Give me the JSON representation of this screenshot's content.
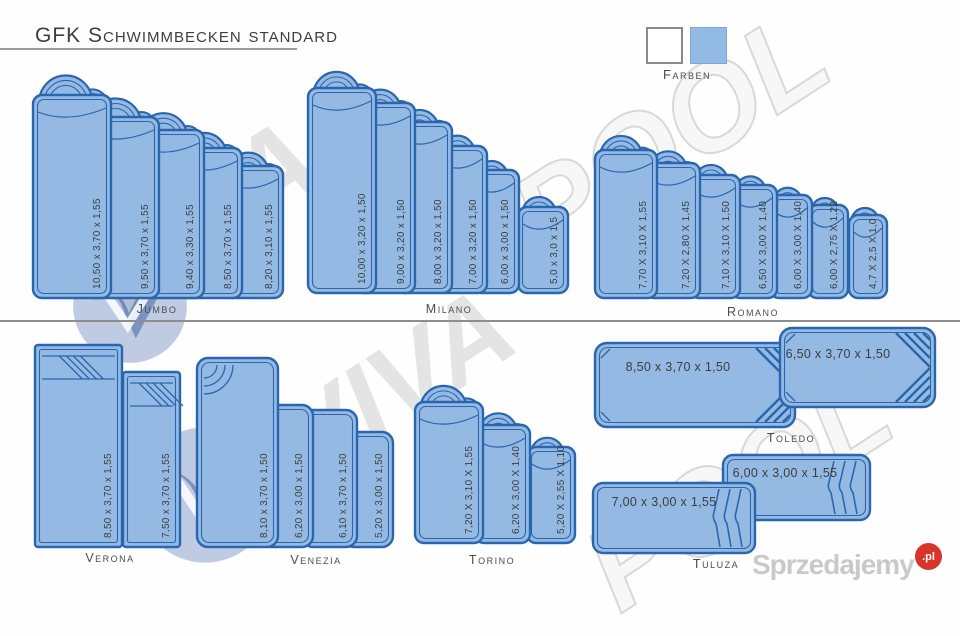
{
  "title": "GFK Schwimmbecken standard",
  "legend": {
    "label": "Farben",
    "swatches": [
      {
        "name": "white",
        "color": "#ffffff"
      },
      {
        "name": "blue",
        "color": "#93bae3"
      }
    ]
  },
  "groups": {
    "jumbo": {
      "label": "Jumbo",
      "pools": [
        "10,50 x 3,70 x 1,55",
        "9,50 x 3,70 x 1,55",
        "9,40 x 3,30 x 1,55",
        "8,50 x 3,70 x 1,55",
        "8,20 x 3,10 x 1,55"
      ]
    },
    "milano": {
      "label": "Milano",
      "pools": [
        "10,00 x 3,20 x 1,50",
        "9,00 x 3,20 x 1,50",
        "8,00 x 3,20 x 1,50",
        "7,00 x 3,20 x 1,50",
        "6,00 x 3,00 x 1,50",
        "5,0 x 3,0 x 1,5"
      ]
    },
    "romano": {
      "label": "Romano",
      "pools": [
        "7,70 X 3,10 X 1,55",
        "7,20 X 2,80 X 1,45",
        "7,10 X 3,10 X 1,50",
        "6,50 X 3,00 X 1,40",
        "6,00 X 3,00 X 1,40",
        "6,00 X 2,75 X 1,22",
        "4,7 X 2,5 X 1,0"
      ]
    },
    "verona": {
      "label": "Verona",
      "pools": [
        "8,50 x 3,70 x 1,55",
        "7,50 x 3,70 x 1,55"
      ]
    },
    "venezia": {
      "label": "Venezia",
      "pools": [
        "8,10 x 3,70 x 1,50",
        "6,20 x 3,00 x 1,50",
        "6,10 x 3,70 x 1,50",
        "5,20 x 3,00 x 1,50"
      ]
    },
    "torino": {
      "label": "Torino",
      "pools": [
        "7,20 X 3,10 X 1,55",
        "6,20 X 3,00 X 1,40",
        "5,20 X 2,55 X 1,10"
      ]
    },
    "toledo": {
      "label": "Toledo",
      "pools": [
        "8,50 x 3,70 x 1,50",
        "6,50 x 3,70 x 1,50"
      ]
    },
    "tuluza": {
      "label": "Tuluza",
      "pools": [
        "7,00 x 3,00 x 1,55",
        "6,00 x 3,00 x 1,55"
      ]
    }
  },
  "watermark": {
    "word_viva": "VIVA",
    "word_pool": "POOL"
  },
  "footer_brand": {
    "name": "Sprzedajemy",
    "tld": ".pl",
    "badge_color": "#d8342c"
  },
  "colors": {
    "pool_fill": "#94bae4",
    "pool_stroke": "#2a66ae",
    "dimension_text": "#3d3d3d"
  }
}
